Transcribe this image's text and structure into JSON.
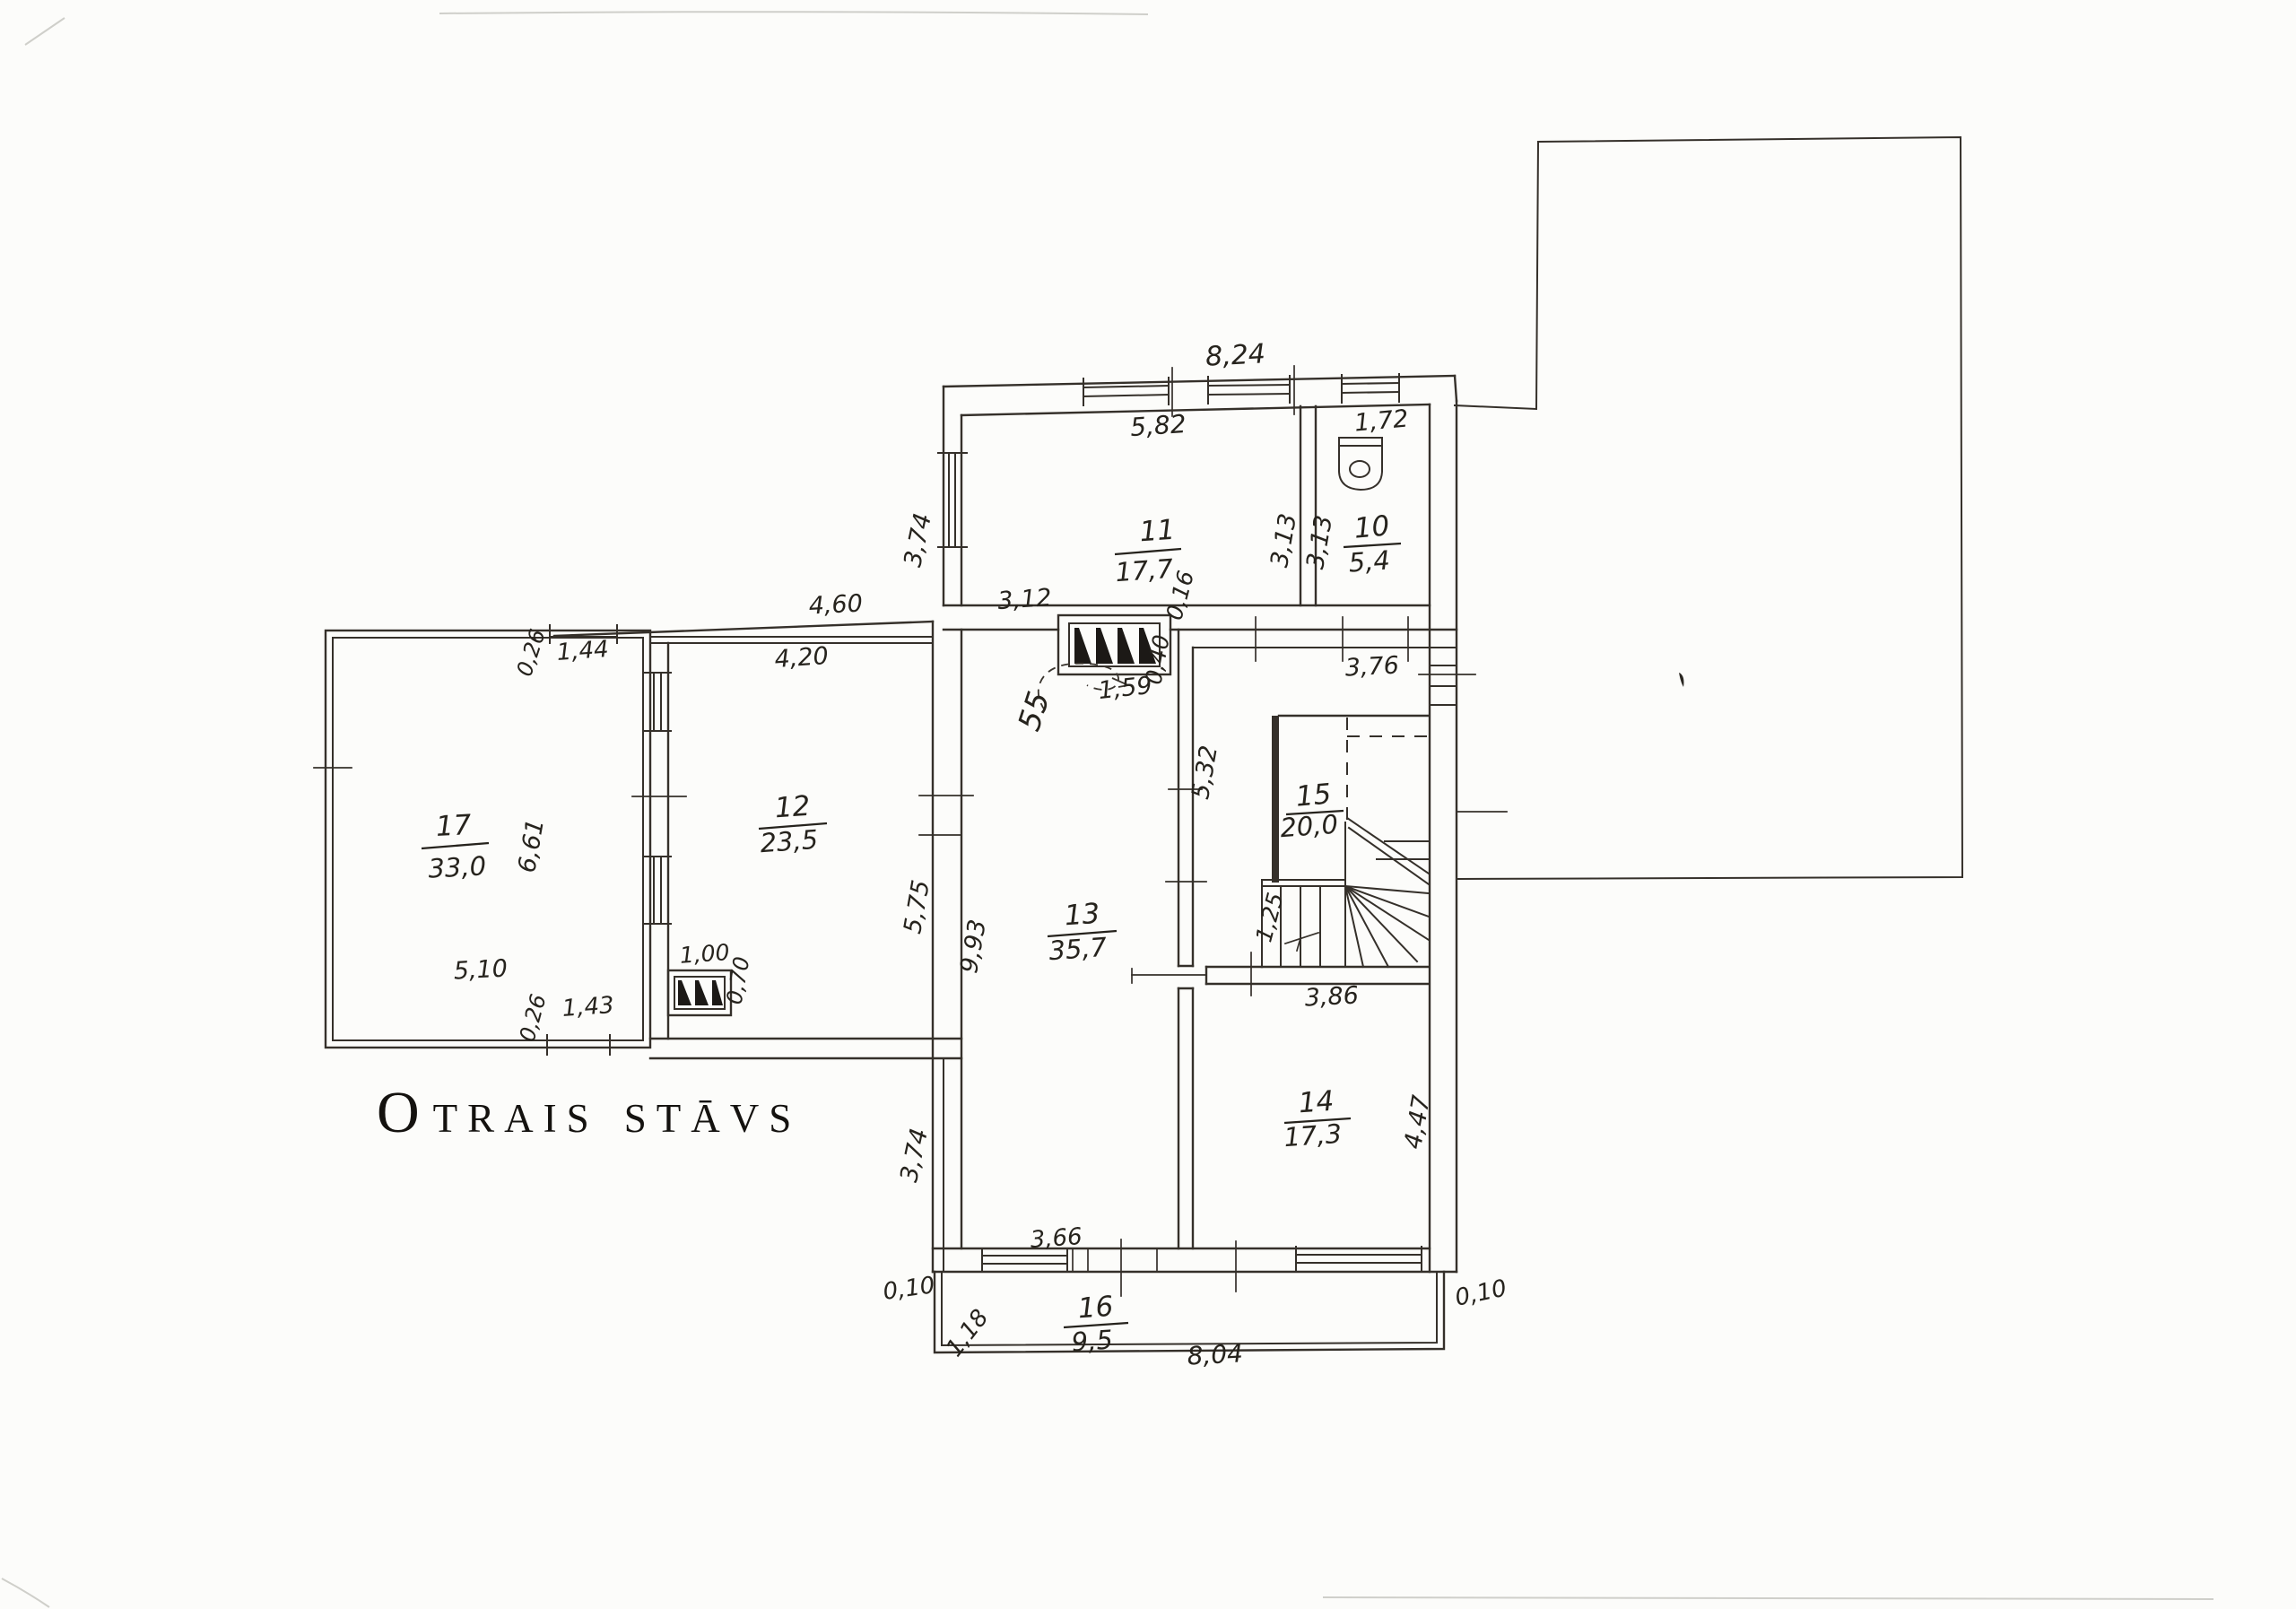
{
  "title": {
    "initial": "O",
    "word1_rest": "TRAIS",
    "word2": "STĀVS"
  },
  "rooms": {
    "r10": {
      "no": "10",
      "area": "5,4"
    },
    "r11": {
      "no": "11",
      "area": "17,7"
    },
    "r12": {
      "no": "12",
      "area": "23,5"
    },
    "r13": {
      "no": "13",
      "area": "35,7"
    },
    "r14": {
      "no": "14",
      "area": "17,3"
    },
    "r15": {
      "no": "15",
      "area": "20,0"
    },
    "r16": {
      "no": "16",
      "area": "9,5"
    },
    "r17": {
      "no": "17",
      "area": "33,0"
    }
  },
  "dims": {
    "top_width": "8,24",
    "r11_width": "5,82",
    "wc_width": "1,72",
    "r11_depth": "3,13",
    "wc_depth": "3,13",
    "wing_left_wall": "3,74",
    "corridor_len": "4,60",
    "r13_top": "3,12",
    "window_159": "1,59",
    "pier_016": "0,16",
    "pier_040": "0,40",
    "hall_width": "3,76",
    "r17_offset_top": "0,26",
    "r17_window_top": "1,44",
    "r12_width": "4,20",
    "r17_width": "5,10",
    "r17_depth": "6,61",
    "r17_offset_bottom": "0,26",
    "r17_window_bottom": "1,43",
    "r12_depth": "5,75",
    "r12_window": "1,00",
    "r12_window_offset": "0,70",
    "r13_depth": "9,93",
    "lower_left_wall": "3,74",
    "hall_depth": "5,32",
    "stair_width": "1,25",
    "stair_run": "3,86",
    "r14_depth": "4,47",
    "r13_bottom": "3,66",
    "balcony_len": "8,04",
    "balcony_depth": "1,18",
    "offset_left": "0,10",
    "offset_right": "0,10"
  },
  "annotations": {
    "handwritten_note": "55"
  },
  "colors": {
    "ink": "#35302a",
    "paper": "#fcfcfa"
  }
}
